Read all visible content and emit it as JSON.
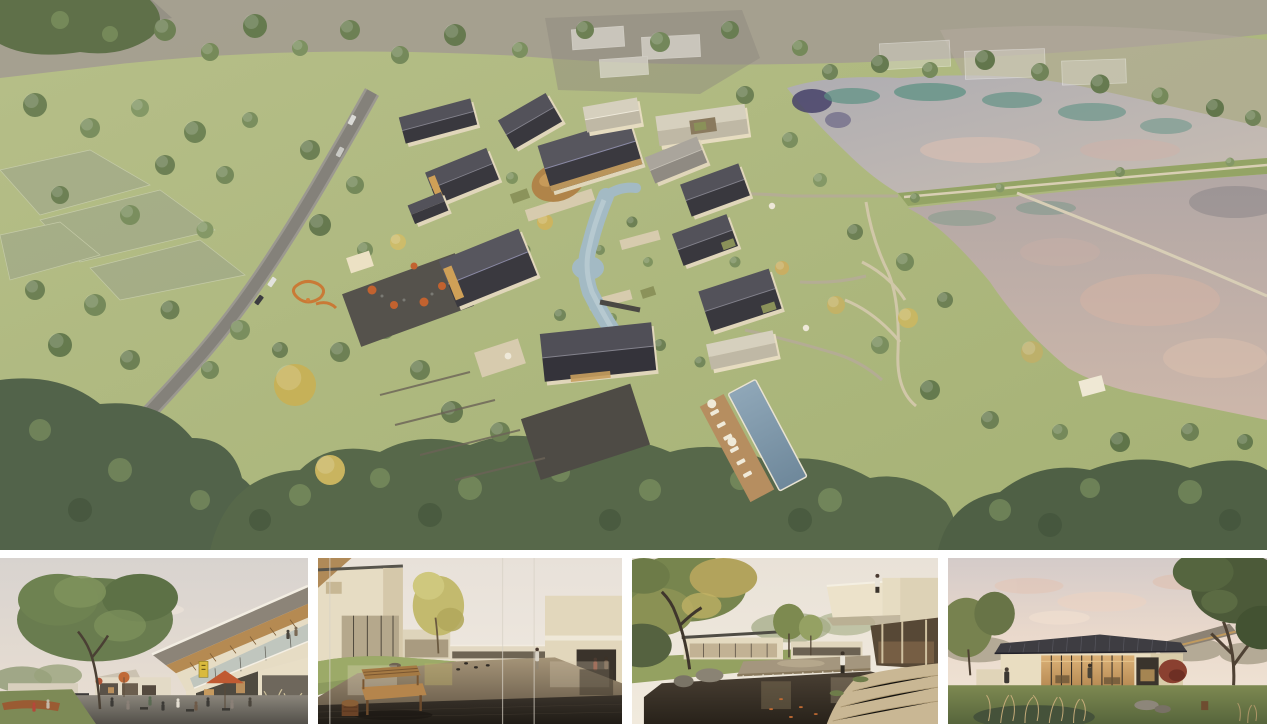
{
  "board": {
    "type": "architectural-rendering-collage",
    "aerial": {
      "description": "Aerial rendering of a village-style resort: a cluster of pitched dark-roof houses around a winding stream and swimming pool, cafe terrace with orange umbrellas, playground, a curving access road through meadows and woodland on the left, and two large ponds separated by a grass embankment path on the right, with translucent future-phase buildings sketched at the top.",
      "features": [
        "access-road",
        "meadow",
        "woodland",
        "village-cluster",
        "stream",
        "amber-court-pond",
        "swimming-pool",
        "pool-deck-loungers",
        "cafe-terrace",
        "playground",
        "stone-terraces",
        "upper-pond",
        "lower-pond",
        "embankment-path",
        "pond-boardwalk",
        "ghost-phase-buildings",
        "net-covered-plots",
        "event-canopy"
      ]
    },
    "panels": [
      {
        "id": "plaza-view",
        "description": "Street-level view of a two-storey timber-soffit building with balcony over a paved plaza: cafe tables, orange umbrellas, a yellow shop sign, people, lawn with children and a large tree."
      },
      {
        "id": "reflecting-pond-view",
        "description": "Courtyard with a shallow reflecting pond seen past a wooden slat bench and stool on a dark timber deck; grass mound, golden tree, cream houses and two people walking under the far building."
      },
      {
        "id": "waterfall-pond-view",
        "description": "Garden court with a stone weir waterfall into a dark koi pond, mature half-autumn tree, glass pavilion on a lawn and a cantilevered balcony where a visitor looks over the water."
      },
      {
        "id": "dusk-pavilion-view",
        "description": "Single-storey glass pavilion glowing warmly at dusk under a pink sky, low dark standing-seam roof, lawns, foreground grasses, rocks, a red maple and a large tree on the right."
      }
    ],
    "palette": {
      "gutter": "#ffffff",
      "meadow": "#aeb87c",
      "field_far": "#a49d90",
      "forest": "#5a6b46",
      "tree_green": "#6d8054",
      "tree_autumn": "#c6b158",
      "road": "#84817a",
      "path": "#d3c7aa",
      "roof_dark": "#3c3b41",
      "roof_light": "#cfc9b6",
      "wall_cream": "#e0d6ba",
      "water_upper": "#b9b3b1",
      "water_lower": "#c0b0a8",
      "water_teal": "#5d9183",
      "water_pink": "#d5b7a9",
      "stream": "#a3bac4",
      "pool": "#7e99ab",
      "umbrella_orange": "#c2622f",
      "terrace_dark": "#55524c",
      "sky_dusk": "#ead9cc",
      "glass_warm": "#d2a968"
    }
  }
}
